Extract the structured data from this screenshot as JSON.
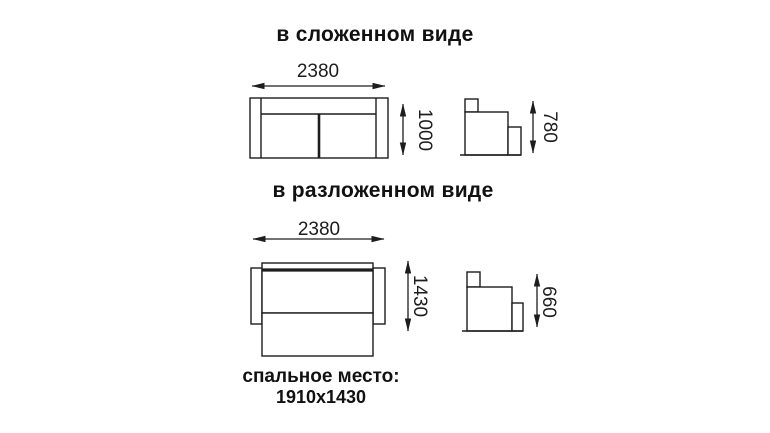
{
  "colors": {
    "line": "#1d1d1d",
    "background": "#ffffff",
    "text": "#111111"
  },
  "sections": [
    {
      "title": "в сложенном виде",
      "dimensions": {
        "width_mm": "2380",
        "height_mm": "1000",
        "side_height_mm": "780"
      }
    },
    {
      "title": "в разложенном виде",
      "dimensions": {
        "width_mm": "2380",
        "depth_mm": "1430",
        "side_height_mm": "660"
      }
    }
  ],
  "caption": {
    "line1": "спальное место:",
    "line2": "1910x1430"
  }
}
